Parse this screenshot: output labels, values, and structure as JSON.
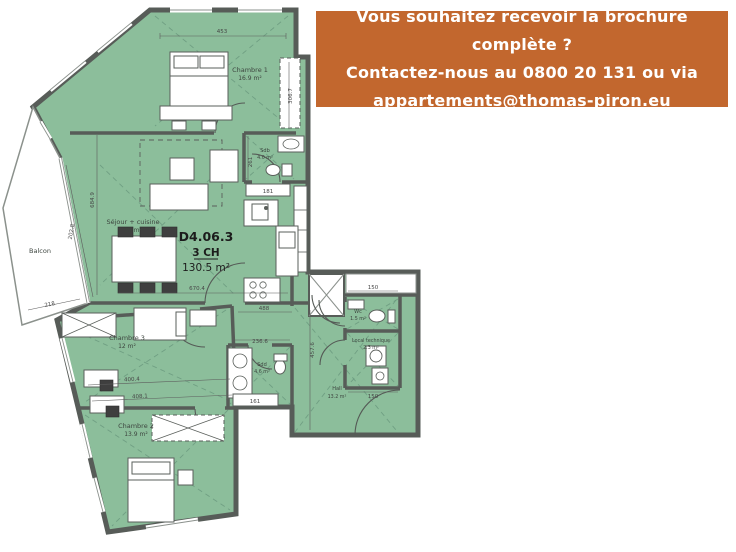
{
  "banner": {
    "line1": "Vous souhaitez recevoir la brochure complète ?",
    "line2": "Contactez-nous au 0800 20 131 ou via",
    "line3": "appartements@thomas-piron.eu"
  },
  "plan": {
    "unit_code": "D4.06.3",
    "unit_type": "3 CH",
    "unit_area": "130.5 m²",
    "rooms": {
      "chambre1": {
        "name": "Chambre 1",
        "area": "16.9 m²"
      },
      "sejour": {
        "name": "Séjour + cuisine",
        "area": "39 m²"
      },
      "balcon": {
        "name": "Balcon"
      },
      "sdb": {
        "name": "Sdb",
        "area": "4.0 m²"
      },
      "chambre3": {
        "name": "Chambre 3",
        "area": "12 m²"
      },
      "sdd": {
        "name": "Sdd",
        "area": "4.6 m²"
      },
      "hall": {
        "name": "Hall",
        "area": "13.2 m²"
      },
      "wc": {
        "name": "Wc",
        "area": "1.5 m²"
      },
      "local_technique": {
        "name": "Local technique",
        "area": "2.3 m²"
      },
      "chambre2": {
        "name": "Chambre 2",
        "area": "13.9 m²"
      }
    },
    "dimensions": {
      "top_width": "453",
      "chambre1_height": "306.7",
      "sejour_height": "684.9",
      "glazing_length": "202.8",
      "balcon_width": "218",
      "sdb_height": "261",
      "sdb_door": "181",
      "sejour_width": "670.4",
      "corridor_width": "488",
      "sdd_width": "236.6",
      "sdd_door": "161",
      "chambre3_width_a": "400.4",
      "chambre3_width_b": "408.1",
      "hall_height": "457.6",
      "wc_width": "150",
      "local_width": "150"
    }
  },
  "colors": {
    "banner_bg": "#c2672e",
    "banner_text": "#ffffff",
    "room_fill": "#8cbe9b",
    "wall": "#575c58"
  }
}
